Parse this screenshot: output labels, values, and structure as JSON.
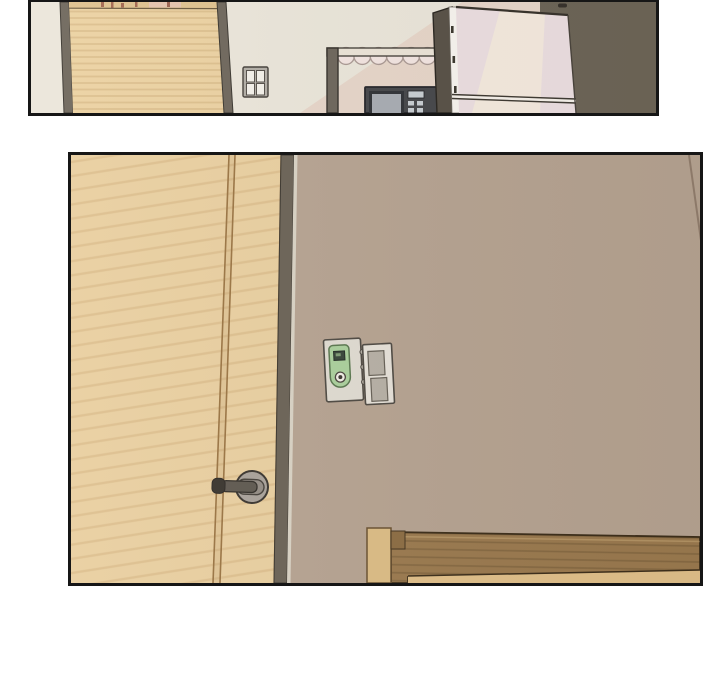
{
  "scene": {
    "type": "webtoon-interior-panels",
    "panel_count": 2,
    "panels": [
      {
        "name": "kitchen-panel",
        "objects": [
          "wooden-door",
          "light-switch",
          "curtained-shelf",
          "microwave",
          "refrigerator",
          "dark-accent-wall"
        ]
      },
      {
        "name": "bedroom-panel",
        "objects": [
          "wooden-door",
          "door-lever-handle",
          "thermostat",
          "light-switch",
          "taupe-wall",
          "bed-headboard"
        ]
      }
    ]
  },
  "colors": {
    "page_bg": "#ffffff",
    "panel_border": "#161616",
    "p1_wall_cream": "#ebe6da",
    "p1_wall_shadow": "#e7d6c9",
    "p1_wall_dark": "#6d6557",
    "p1_door_wood": "#ecd2a2",
    "p1_door_frame": "#6f675c",
    "p1_door_top_trim": "#dfc28f",
    "p1_switch_plate": "#b3aea6",
    "p1_switch_rocker": "#f4f1ea",
    "canopy_fabric": "#f3e5e1",
    "canopy_bar": "#ece4d7",
    "shelf_post": "#6e675c",
    "microwave_body": "#47484b",
    "microwave_screen": "#a9adb3",
    "microwave_buttons": "#c9ced3",
    "fridge_front": "#ecdfe1",
    "fridge_highlight": "#f5eade",
    "fridge_side": "#595247",
    "fridge_edge": "#f8f4ef",
    "fridge_divider": "#f6f1ea",
    "p2_wall_taupe": "#b6a391",
    "p2_door_wood": "#e9cfa0",
    "p2_door_edge_dark": "#6b6356",
    "p2_door_edge_light": "#d9d2c4",
    "p2_door_seam": "#9a7443",
    "rosette": "#a9a29a",
    "lever": "#5f5950",
    "lever_tip": "#3a352e",
    "thermo_plate": "#e0dbd1",
    "thermo_green": "#abd09c",
    "thermo_screen": "#39463a",
    "switch2_plate": "#e6e1d8",
    "switch2_rocker": "#b7b0a5",
    "headboard_rail": "#9b7a4f",
    "headboard_panel": "#e1c08a",
    "headboard_post": "#dcbd85",
    "headboard_cap": "#8d6d44"
  }
}
